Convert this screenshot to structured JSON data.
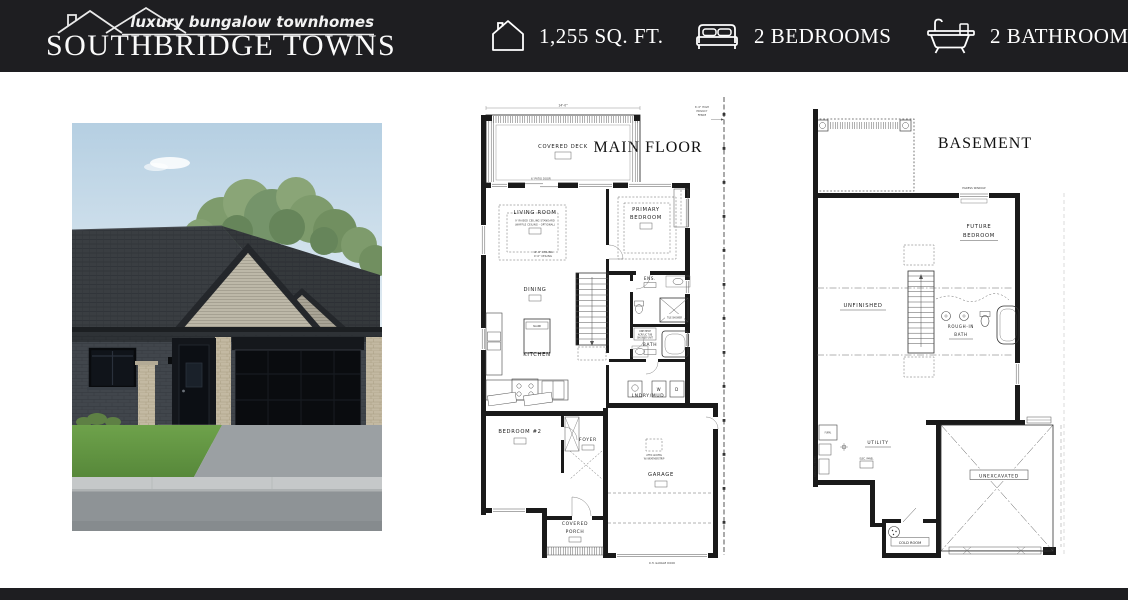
{
  "header": {
    "tagline": "luxury bungalow townhomes",
    "brand": "SOUTHBRIDGE TOWNS",
    "stats": [
      {
        "icon": "house-icon",
        "label": "1,255 SQ. FT."
      },
      {
        "icon": "bed-icon",
        "label": "2 BEDROOMS"
      },
      {
        "icon": "bathtub-icon",
        "label": "2 BATHROOMS"
      }
    ]
  },
  "colors": {
    "header_bg": "#1e1e21",
    "text_on_dark": "#ffffff",
    "plan_line": "#1a1a1a",
    "sky": "#b5cfe2",
    "roof": "#3a3e42",
    "grass": "#609542"
  },
  "main_floor": {
    "title": "MAIN FLOOR",
    "rooms": {
      "covered_deck": "COVERED DECK",
      "living_room": "LIVING ROOM",
      "living_note_1": "9' RAISED CEILING STANDARD",
      "living_note_2": "(WAFFLE CEILING - OPTIONAL)",
      "living_ceiling_1": "10'-0\" CEILING",
      "living_ceiling_2": "9'-0\" CEILING",
      "primary_1": "PRIMARY",
      "primary_2": "BEDROOM",
      "dining": "DINING",
      "kitchen": "KITCHEN",
      "island": "ISLAND",
      "ensuite": "ENS.",
      "bath": "BATH",
      "laundry": "LNDRY/MUD",
      "bedroom2": "BEDROOM #2",
      "foyer": "FOYER",
      "garage": "GARAGE",
      "porch_1": "COVERED",
      "porch_2": "PORCH",
      "washer": "W",
      "dryer": "D"
    },
    "notes": {
      "deck_width": "14'-0\"",
      "patio_door": "6' PATIO DOOR",
      "fence_1": "6'-0\" HIGH",
      "fence_2": "PRIVACY",
      "fence_3": "FENCE",
      "tile_shower": "TILE SHOWER",
      "tub_1": "ONE PIECE",
      "tub_2": "ACRYLIC TUB",
      "tub_3": "SHOWER UNIT",
      "attic_1": "ATTIC ACCESS",
      "attic_2": "W/ WEATHERSTRIP",
      "garage_door": "O.H. GARAGE DOOR"
    }
  },
  "basement": {
    "title": "BASEMENT",
    "rooms": {
      "future_1": "FUTURE",
      "future_2": "BEDROOM",
      "unfinished": "UNFINISHED",
      "rough_1": "ROUGH-IN",
      "rough_2": "BATH",
      "utility": "UTILITY",
      "cold_room": "COLD ROOM",
      "unexcavated": "UNEXCAVATED"
    },
    "notes": {
      "egress": "EGRESS WINDOW",
      "furnace": "FURN.",
      "heater": "TANKLESS HEATER",
      "panel": "ELEC. PANEL"
    }
  }
}
